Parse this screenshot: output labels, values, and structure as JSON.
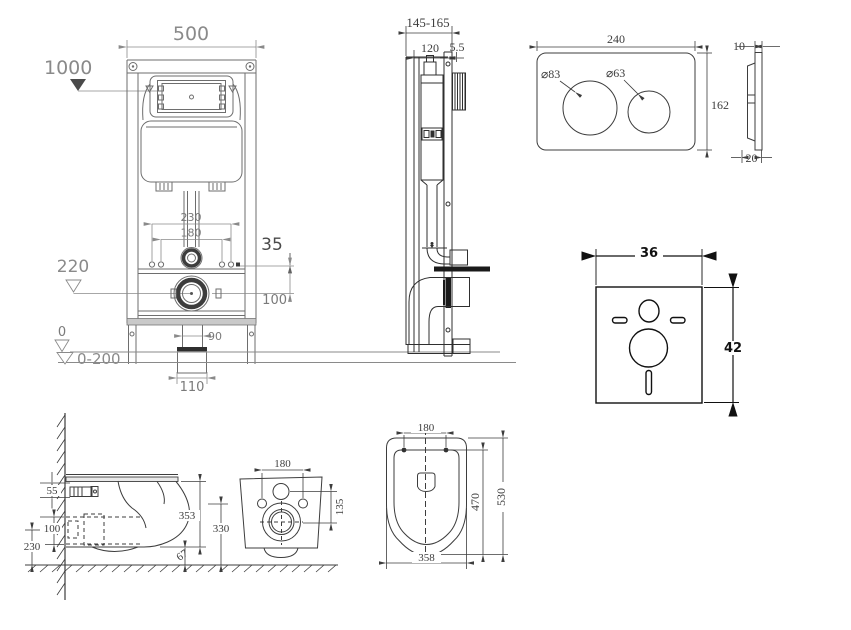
{
  "drawing": {
    "frame_front": {
      "width": "500",
      "install_height": "1000",
      "bolt_span_outer": "230",
      "bolt_span_inner": "180",
      "offset": "35",
      "outlet_height": "220",
      "drain_drop": "100",
      "outlet_pipe_width": "90",
      "outlet_box_width": "110",
      "floor_level": "0",
      "adjust_range": "0-200"
    },
    "frame_side": {
      "depth_range": "145-165",
      "frame_depth": "120",
      "gap": "5.5"
    },
    "flush_plate": {
      "width": "240",
      "height": "162",
      "large_button": "⌀83",
      "small_button": "⌀63",
      "thickness": "10",
      "base_depth": "20"
    },
    "sound_mat": {
      "width": "36",
      "height": "42"
    },
    "toilet_side": {
      "fixing_offset": "55",
      "drain_height": "100",
      "clearance": "230",
      "bowl_height": "353",
      "floor_gap": "67"
    },
    "toilet_back": {
      "fixing_span": "180",
      "drain_offset": "135",
      "fixing_height": "330"
    },
    "toilet_top": {
      "hinge_span": "180",
      "inner_length": "470",
      "total_length": "530",
      "width": "358"
    }
  }
}
